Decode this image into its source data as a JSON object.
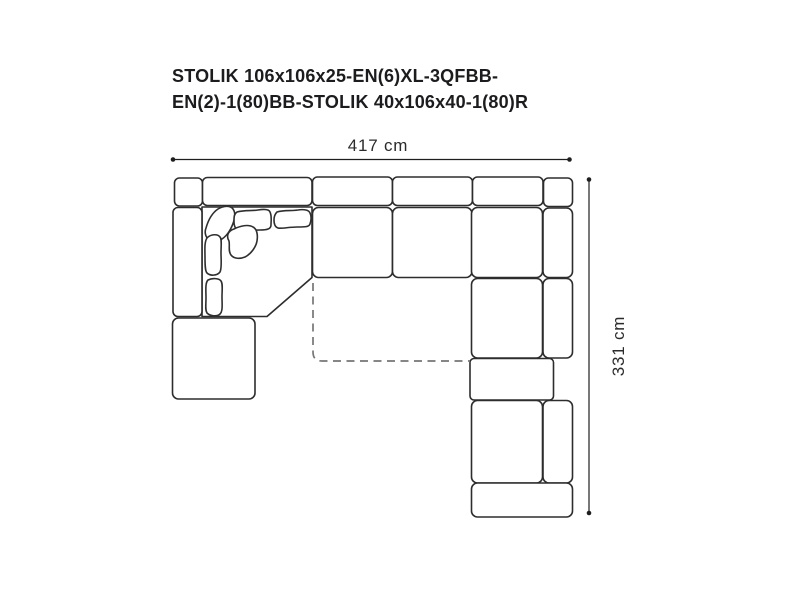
{
  "title": {
    "line1": "STOLIK 106x106x25-EN(6)XL-3QFBB-",
    "line2": "EN(2)-1(80)BB-STOLIK 40x106x40-1(80)R"
  },
  "dimensions": {
    "width_label": "417 cm",
    "height_label": "331 cm"
  },
  "colors": {
    "outline": "#2d2d2d",
    "dashed_outline": "#767676",
    "title_text": "#1c1c1e",
    "dimension_text": "#2b2b2b",
    "background": "#ffffff"
  },
  "diagram": {
    "type": "sectional-sofa-top-view",
    "pieces": [
      "backrest-left-cap",
      "backrest-wide",
      "backrest-1",
      "backrest-2",
      "backrest-3",
      "backrest-right-cap",
      "left-armrest",
      "corner-seat",
      "seat-1",
      "seat-2",
      "chaise-seat-top",
      "chaise-seat-mid",
      "chaise-seat-bottom",
      "right-armrest-top",
      "right-armrest-mid",
      "right-armrest-bottom",
      "side-table-right",
      "bottom-cap",
      "side-table-left",
      "ottoman-dashed-outline",
      "corner-pillows"
    ]
  }
}
